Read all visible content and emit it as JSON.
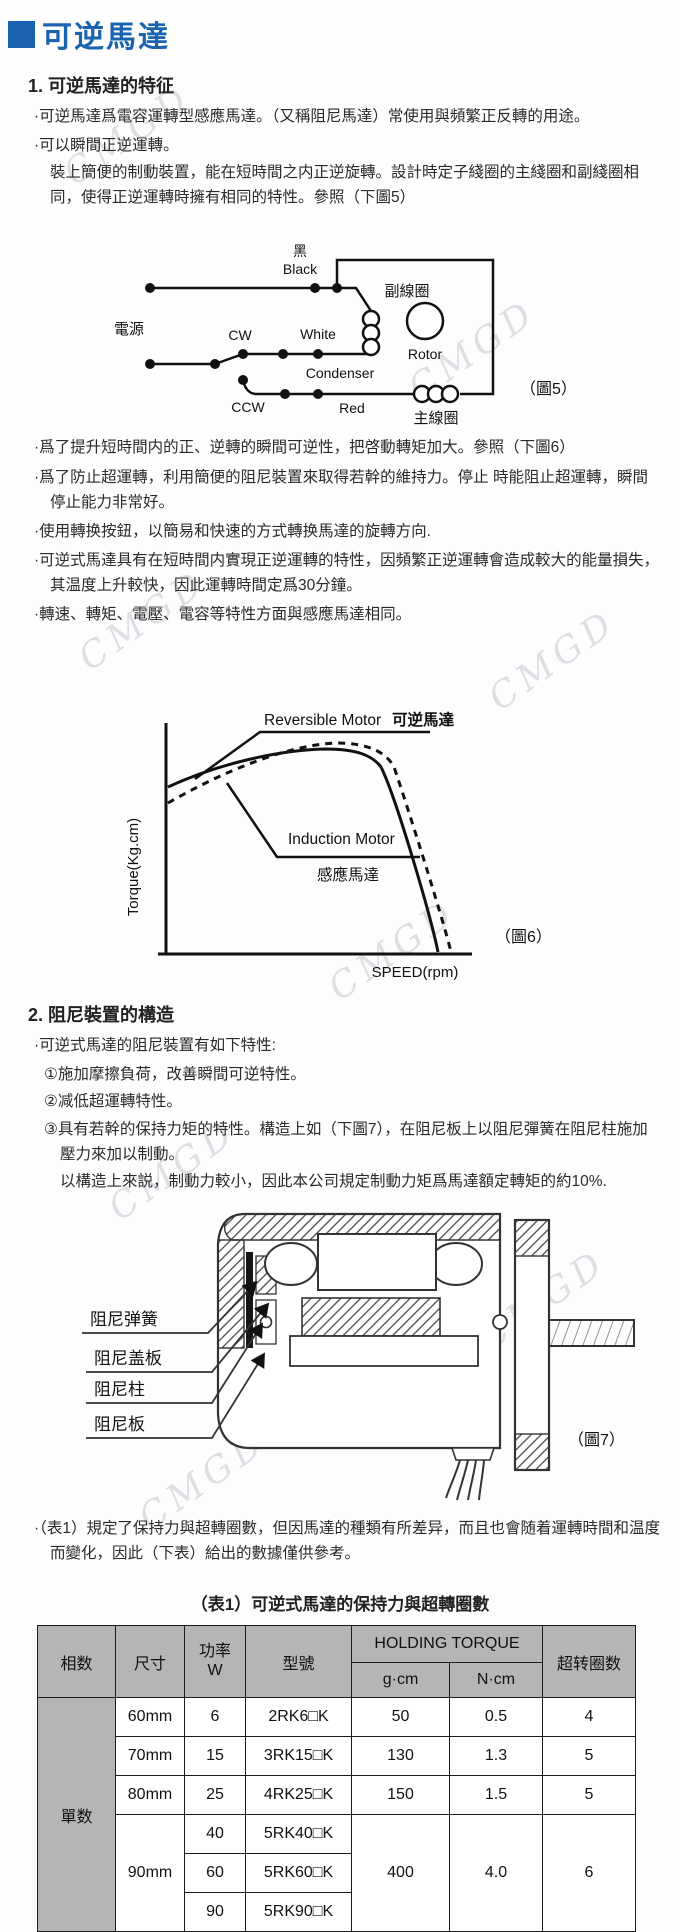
{
  "watermark": "CMGD",
  "page_title": "可逆馬達",
  "section1": {
    "heading": "1. 可逆馬達的特征",
    "b1": "·可逆馬達爲電容運轉型感應馬達。（又稱阻尼馬達）常使用與頻繁正反轉的用途。",
    "b2": "·可以瞬間正逆運轉。",
    "b2_cont": "裝上簡便的制動裝置，能在短時間之内正逆旋轉。設計時定子綫圈的主綫圈和副綫圈相同，使得正逆運轉時擁有相同的特性。參照（下圖5）",
    "b3": "·爲了提升短時間内的正、逆轉的瞬間可逆性，把啓動轉矩加大。參照（下圖6）",
    "b4": "·爲了防止超運轉，利用簡便的阻尼裝置來取得若幹的維持力。停止 時能阻止超運轉，瞬間停止能力非常好。",
    "b5": "·使用轉换按鈕，以簡易和快速的方式轉换馬達的旋轉方向.",
    "b6": "·可逆式馬達具有在短時間内實現正逆運轉的特性，因頻繁正逆運轉會造成較大的能量損失，其温度上升較快，因此運轉時間定爲30分鐘。",
    "b7": "·轉速、轉矩、電壓、電容等特性方面與感應馬達相同。"
  },
  "fig5": {
    "caption": "（圖5）",
    "power": "電源",
    "black_cn": "黑",
    "black_en": "Black",
    "white": "White",
    "red": "Red",
    "cw": "CW",
    "ccw": "CCW",
    "condenser": "Condenser",
    "rotor": "Rotor",
    "aux_coil": "副線圈",
    "main_coil": "主線圈"
  },
  "fig6": {
    "caption": "（圖6）",
    "reversible_en": "Reversible Motor",
    "reversible_cn": "可逆馬達",
    "induction_en": "Induction Motor",
    "induction_cn": "感應馬達",
    "y_axis": "Torque(Kg.cm)",
    "x_axis": "SPEED(rpm)"
  },
  "chart_data": {
    "type": "line",
    "title": "",
    "xlabel": "SPEED(rpm)",
    "ylabel": "Torque(Kg.cm)",
    "grid": false,
    "legend_position": "inline-annotations",
    "axes_numeric_labels": false,
    "series": [
      {
        "name": "Reversible Motor 可逆馬達",
        "style": "solid",
        "x": [
          0,
          10,
          20,
          30,
          40,
          50,
          60,
          70,
          78,
          84,
          88
        ],
        "y": [
          55,
          61,
          65,
          68,
          70,
          70,
          69,
          65,
          50,
          20,
          0
        ]
      },
      {
        "name": "Induction Motor 感應馬達",
        "style": "dashed",
        "x": [
          0,
          10,
          20,
          30,
          40,
          50,
          60,
          72,
          80,
          87,
          91
        ],
        "y": [
          50,
          58,
          64,
          68,
          71,
          72,
          71,
          67,
          52,
          20,
          0
        ]
      }
    ]
  },
  "section2": {
    "heading": "2. 阻尼裝置的構造",
    "b1": "·可逆式馬達的阻尼裝置有如下特性:",
    "i1": "①施加摩擦負荷，改善瞬間可逆特性。",
    "i2": "②减低超運轉特性。",
    "i3": "③具有若幹的保持力矩的特性。構造上如（下圖7），在阻尼板上以阻尼彈簧在阻尼柱施加壓力來加以制動。",
    "i3_cont": "以構造上來説，制動力較小，因此本公司規定制動力矩爲馬達額定轉矩的約10%."
  },
  "fig7": {
    "caption": "（圖7）",
    "spring": "阻尼弹簧",
    "cover": "阻尼盖板",
    "pillar": "阻尼柱",
    "plate": "阻尼板"
  },
  "note": "·（表1）規定了保持力與超轉圈數，但因馬達的種類有所差异，而且也會随着運轉時間和温度而變化，因此（下表）給出的數據僅供參考。",
  "table": {
    "title": "（表1）可逆式馬達的保持力與超轉圈數",
    "h_phase": "相数",
    "h_size": "尺寸",
    "h_power1": "功率",
    "h_power2": "W",
    "h_model": "型號",
    "h_holding": "HOLDING TORQUE",
    "h_gcm": "g·cm",
    "h_ncm": "N·cm",
    "h_overrun": "超转圈数",
    "phase": "單数",
    "rows": [
      {
        "size": "60mm",
        "power": "6",
        "model": "2RK6□K",
        "gcm": "50",
        "ncm": "0.5",
        "overrun": "4"
      },
      {
        "size": "70mm",
        "power": "15",
        "model": "3RK15□K",
        "gcm": "130",
        "ncm": "1.3",
        "overrun": "5"
      },
      {
        "size": "80mm",
        "power": "25",
        "model": "4RK25□K",
        "gcm": "150",
        "ncm": "1.5",
        "overrun": "5"
      },
      {
        "size": "90mm",
        "power": "40",
        "model": "5RK40□K",
        "gcm": "400",
        "ncm": "4.0",
        "overrun": "6"
      },
      {
        "power": "60",
        "model": "5RK60□K"
      },
      {
        "power": "90",
        "model": "5RK90□K"
      }
    ]
  }
}
